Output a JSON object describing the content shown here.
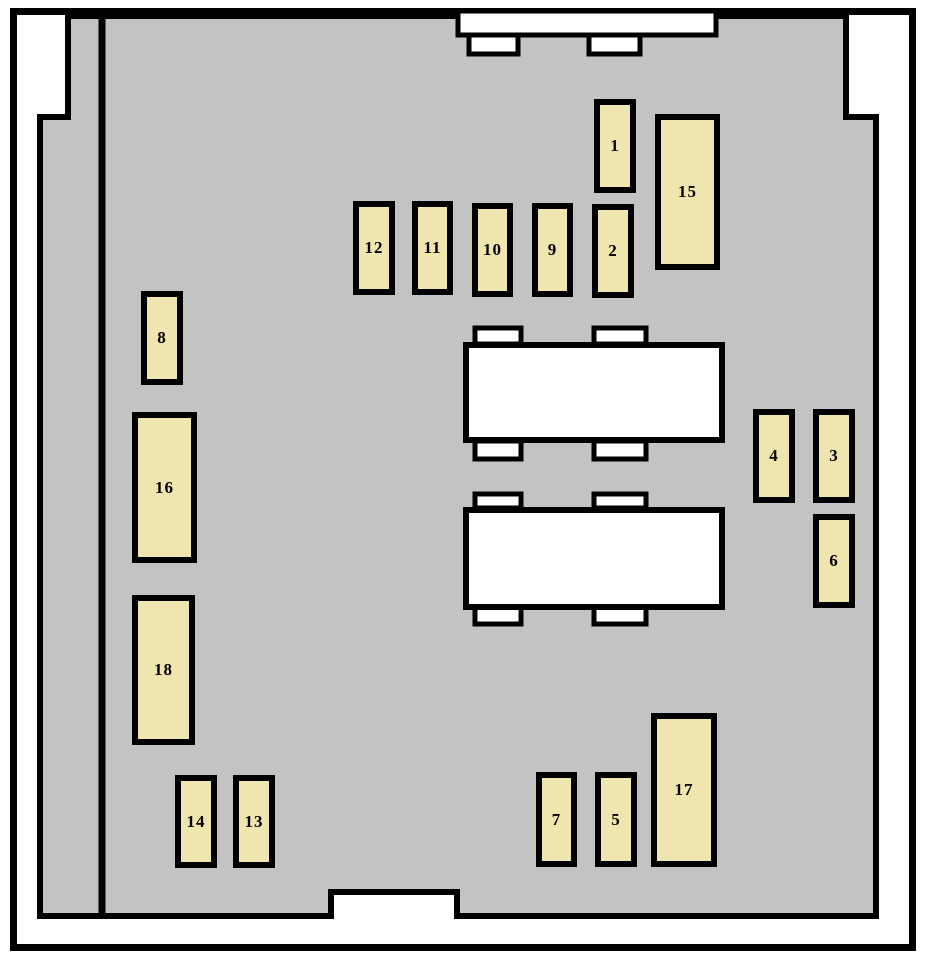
{
  "colors": {
    "page_background": "#ffffff",
    "panel": "#c3c3c3",
    "outline": "#000000",
    "fuse": "#efe5ae",
    "relay": "#ffffff"
  },
  "fuses": [
    {
      "label": "1"
    },
    {
      "label": "2"
    },
    {
      "label": "3"
    },
    {
      "label": "4"
    },
    {
      "label": "5"
    },
    {
      "label": "6"
    },
    {
      "label": "7"
    },
    {
      "label": "8"
    },
    {
      "label": "9"
    },
    {
      "label": "10"
    },
    {
      "label": "11"
    },
    {
      "label": "12"
    },
    {
      "label": "13"
    },
    {
      "label": "14"
    },
    {
      "label": "15"
    },
    {
      "label": "16"
    },
    {
      "label": "17"
    },
    {
      "label": "18"
    }
  ]
}
